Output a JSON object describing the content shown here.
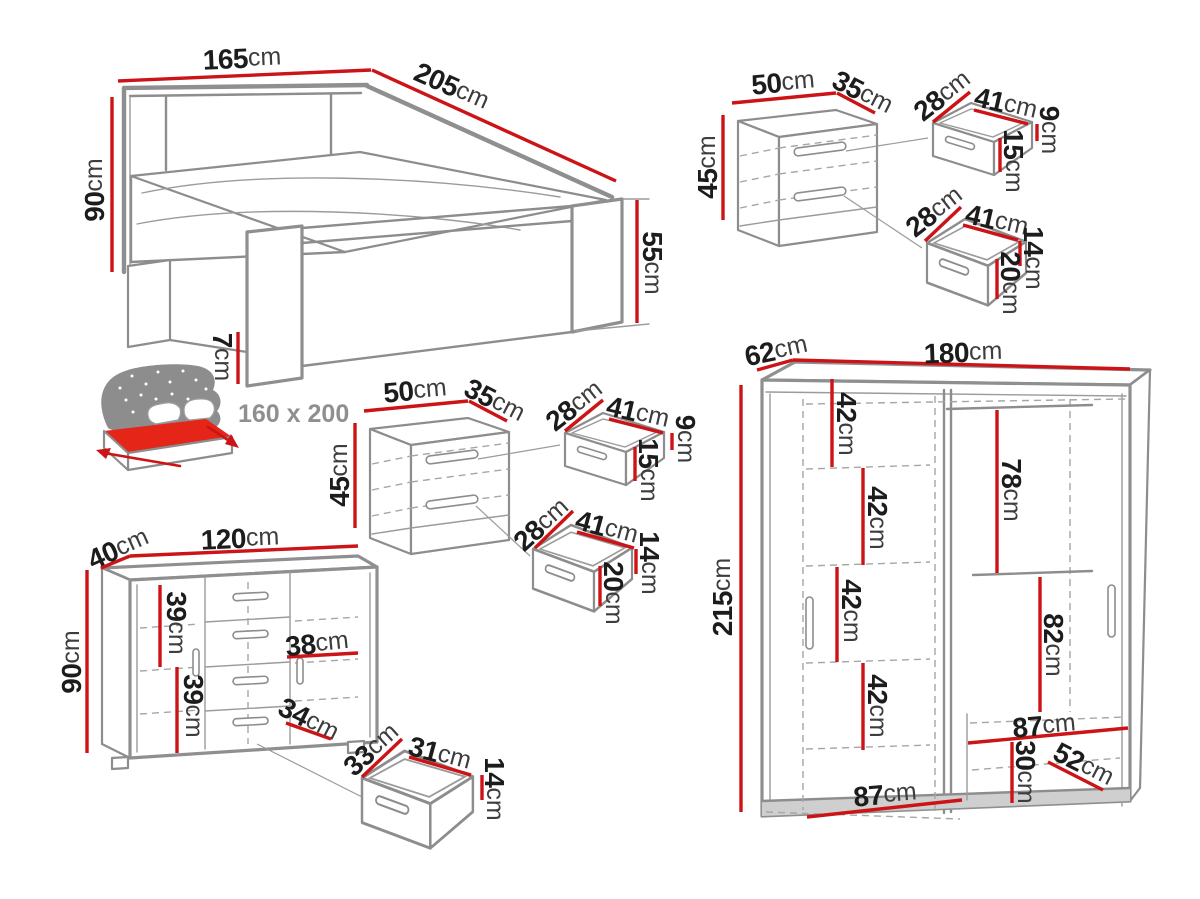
{
  "colors": {
    "dimension_red": "#cc1417",
    "furniture_line_gray": "#8d8d8d",
    "mattress_red": "#e42518",
    "icon_gray": "#8d8d8d",
    "text_black": "#1c1c1c"
  },
  "bed": {
    "width": {
      "v": "165",
      "u": "cm"
    },
    "length": {
      "v": "205",
      "u": "cm"
    },
    "height": {
      "v": "90",
      "u": "cm"
    },
    "footboard_height": {
      "v": "55",
      "u": "cm"
    },
    "leg_height": {
      "v": "7",
      "u": "cm"
    },
    "mattress_size": "160 x 200"
  },
  "nightstand": {
    "width": {
      "v": "50",
      "u": "cm"
    },
    "depth": {
      "v": "35",
      "u": "cm"
    },
    "height": {
      "v": "45",
      "u": "cm"
    },
    "top_drawer": {
      "depth": {
        "v": "28",
        "u": "cm"
      },
      "width": {
        "v": "41",
        "u": "cm"
      },
      "inner_height": {
        "v": "9",
        "u": "cm"
      },
      "front_height": {
        "v": "15",
        "u": "cm"
      }
    },
    "bottom_drawer": {
      "depth": {
        "v": "28",
        "u": "cm"
      },
      "width": {
        "v": "41",
        "u": "cm"
      },
      "inner_height": {
        "v": "14",
        "u": "cm"
      },
      "front_height": {
        "v": "20",
        "u": "cm"
      }
    }
  },
  "dresser": {
    "width": {
      "v": "120",
      "u": "cm"
    },
    "depth": {
      "v": "40",
      "u": "cm"
    },
    "height": {
      "v": "90",
      "u": "cm"
    },
    "upper_inner_height": {
      "v": "39",
      "u": "cm"
    },
    "lower_inner_height": {
      "v": "39",
      "u": "cm"
    },
    "right_inner_width": {
      "v": "38",
      "u": "cm"
    },
    "drawer_front_width": {
      "v": "34",
      "u": "cm"
    },
    "drawer": {
      "depth": {
        "v": "33",
        "u": "cm"
      },
      "width": {
        "v": "31",
        "u": "cm"
      },
      "front_height": {
        "v": "14",
        "u": "cm"
      }
    }
  },
  "wardrobe": {
    "depth": {
      "v": "62",
      "u": "cm"
    },
    "width": {
      "v": "180",
      "u": "cm"
    },
    "height": {
      "v": "215",
      "u": "cm"
    },
    "shelf_gaps": [
      {
        "v": "42",
        "u": "cm"
      },
      {
        "v": "42",
        "u": "cm"
      },
      {
        "v": "42",
        "u": "cm"
      },
      {
        "v": "42",
        "u": "cm"
      }
    ],
    "hanging_height": {
      "v": "78",
      "u": "cm"
    },
    "lower_section_height": {
      "v": "82",
      "u": "cm"
    },
    "right_inner_width": {
      "v": "87",
      "u": "cm"
    },
    "drawer_height": {
      "v": "30",
      "u": "cm"
    },
    "drawer_diagonal": {
      "v": "52",
      "u": "cm"
    },
    "left_inner_width": {
      "v": "87",
      "u": "cm"
    }
  }
}
